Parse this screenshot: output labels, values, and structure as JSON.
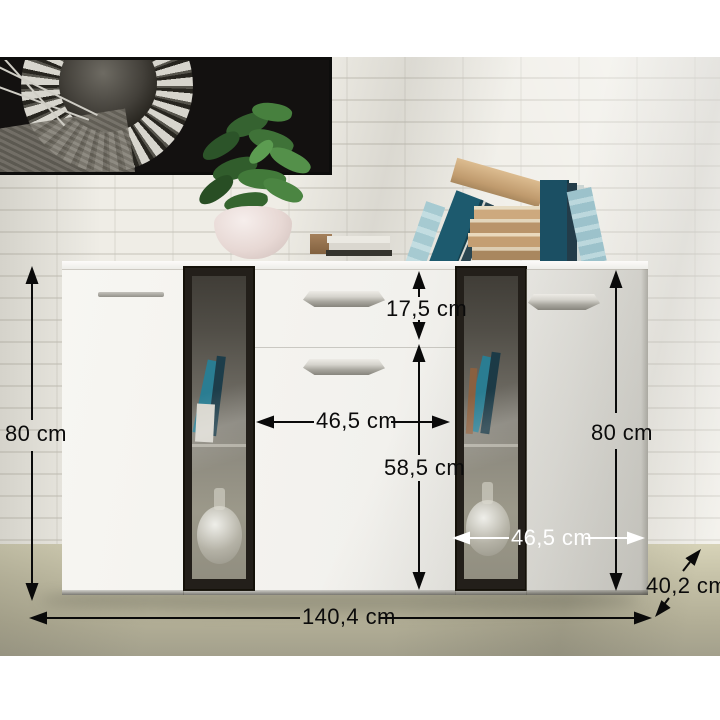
{
  "image": {
    "type": "furniture-product-photo-with-dimension-annotations",
    "subject": "White sideboard with two dark glass display doors, center drawer and doors, styled with books, plant and framed spiral-staircase artwork"
  },
  "annotations": {
    "height_left": "80 cm",
    "height_right": "80 cm",
    "drawer_height": "17,5 cm",
    "lower_section_height": "58,5 cm",
    "center_width": "46,5 cm",
    "right_width": "46,5 cm",
    "total_width": "140,4 cm",
    "depth": "40,2 cm"
  },
  "style": {
    "dimension_line_color": "#0a0a0a",
    "dimension_line_alt_color": "#ffffff",
    "wall_color": "#efede6",
    "floor_color": "#b2ae96",
    "cabinet_color": "#f5f4f0",
    "glass_frame_color": "#231f1a",
    "book_teal": "#1d5a6e",
    "book_tan": "#c8a478",
    "plant_green": "#3d6b38"
  }
}
